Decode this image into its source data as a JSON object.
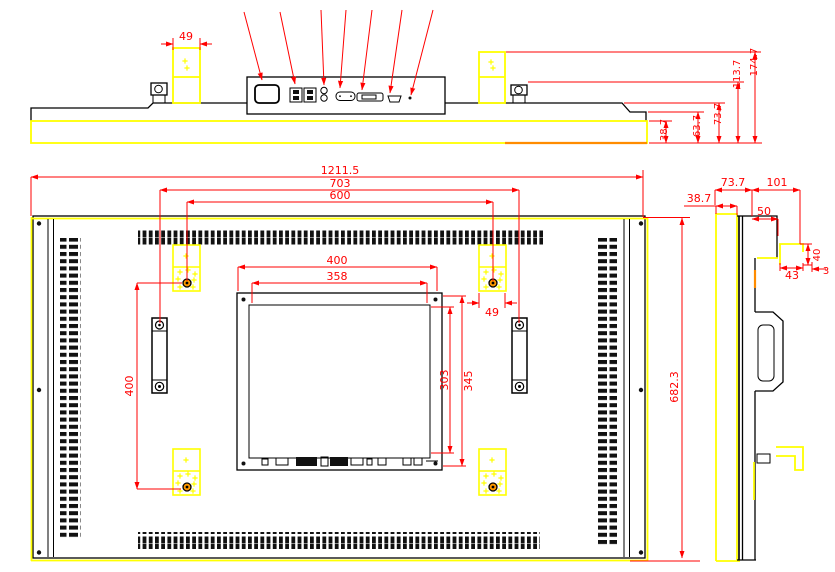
{
  "drawing": {
    "title": "LCD monitor outline dimensional drawing",
    "colors": {
      "dimension": "#ff0000",
      "highlight": "#ffff00",
      "outline": "#000000",
      "screw_accent": "#ff9900",
      "background": "#ffffff"
    },
    "views": {
      "top_view": {
        "ports": [
          "power-inlet",
          "usb-ports",
          "audio-jacks",
          "vga-port",
          "dvi-port",
          "hdmi-port",
          "ir-sensor"
        ],
        "dims": {
          "vesa_pad_width": "49",
          "bezel_depth": "38.7",
          "step_depth": "63.7",
          "body_depth": "73.7",
          "ear_depth": "113.7",
          "pad_block_depth": "174.7"
        }
      },
      "rear_view": {
        "dims": {
          "overall_width": "1211.5",
          "handle_span": "703",
          "pad_span_horizontal": "600",
          "pc_box_width": "400",
          "pc_box_opening_width": "358",
          "pc_box_height": "345",
          "pc_box_opening_height": "303",
          "pad_span_vertical": "400",
          "pad_width": "49",
          "overall_height": "682.3"
        }
      },
      "side_view": {
        "dims": {
          "bezel_depth": "38.7",
          "front_depth": "73.7",
          "rear_depth": "101",
          "bay_depth": "50",
          "bracket_width": "43",
          "bracket_height": "40",
          "bracket_lip": "3"
        }
      }
    }
  }
}
